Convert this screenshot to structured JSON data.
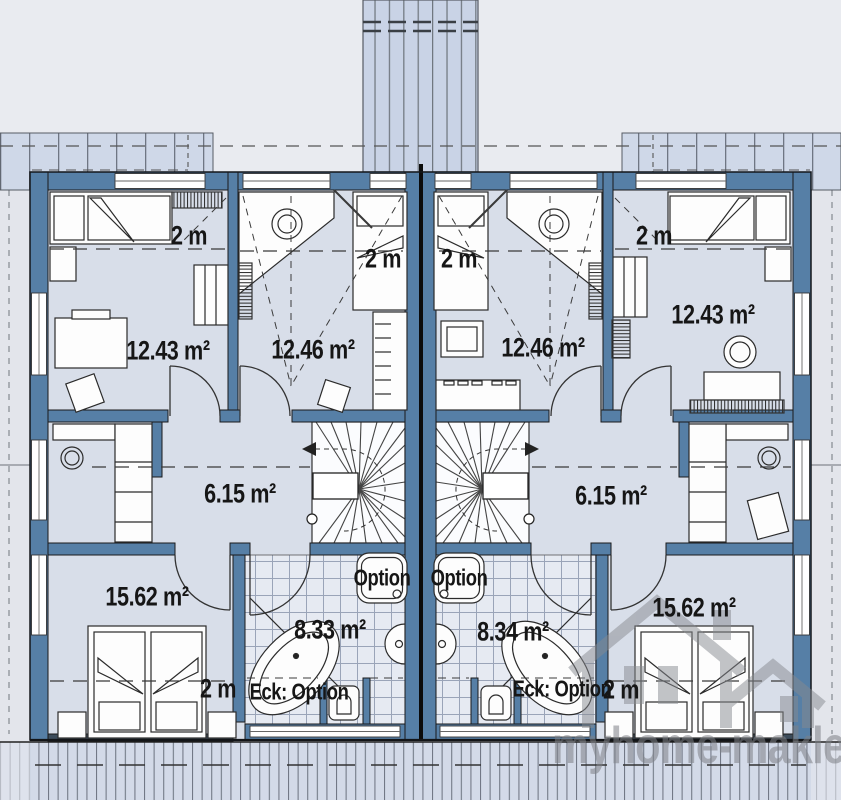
{
  "watermark": {
    "brand": "myhome-makler"
  },
  "units": {
    "left": {
      "bedroom_top": {
        "area": "12.43 m²",
        "headroom": "2 m"
      },
      "child_room": {
        "area": "12.46 m²",
        "headroom": "2 m"
      },
      "hall": {
        "area": "6.15 m²"
      },
      "bath": {
        "area": "8.33 m²",
        "shower_option": "Option",
        "tub_option": "Eck: Option"
      },
      "bedroom_main": {
        "area": "15.62 m²",
        "headroom": "2 m"
      }
    },
    "right": {
      "bedroom_top": {
        "area": "12.43 m²",
        "headroom": "2 m"
      },
      "child_room": {
        "area": "12.46 m²",
        "headroom": "2 m"
      },
      "hall": {
        "area": "6.15 m²"
      },
      "bath": {
        "area": "8.34 m²",
        "shower_option": "Option",
        "tub_option": "Eck: Option"
      },
      "bedroom_main": {
        "area": "15.62 m²",
        "headroom": "2 m"
      }
    }
  },
  "colors": {
    "wall": "#567fa6",
    "floor": "#d8dee9",
    "roof_band": "#cfd8e8",
    "tile": "#e6eaf2",
    "ink": "#161616",
    "watermark": "#7e8187"
  }
}
